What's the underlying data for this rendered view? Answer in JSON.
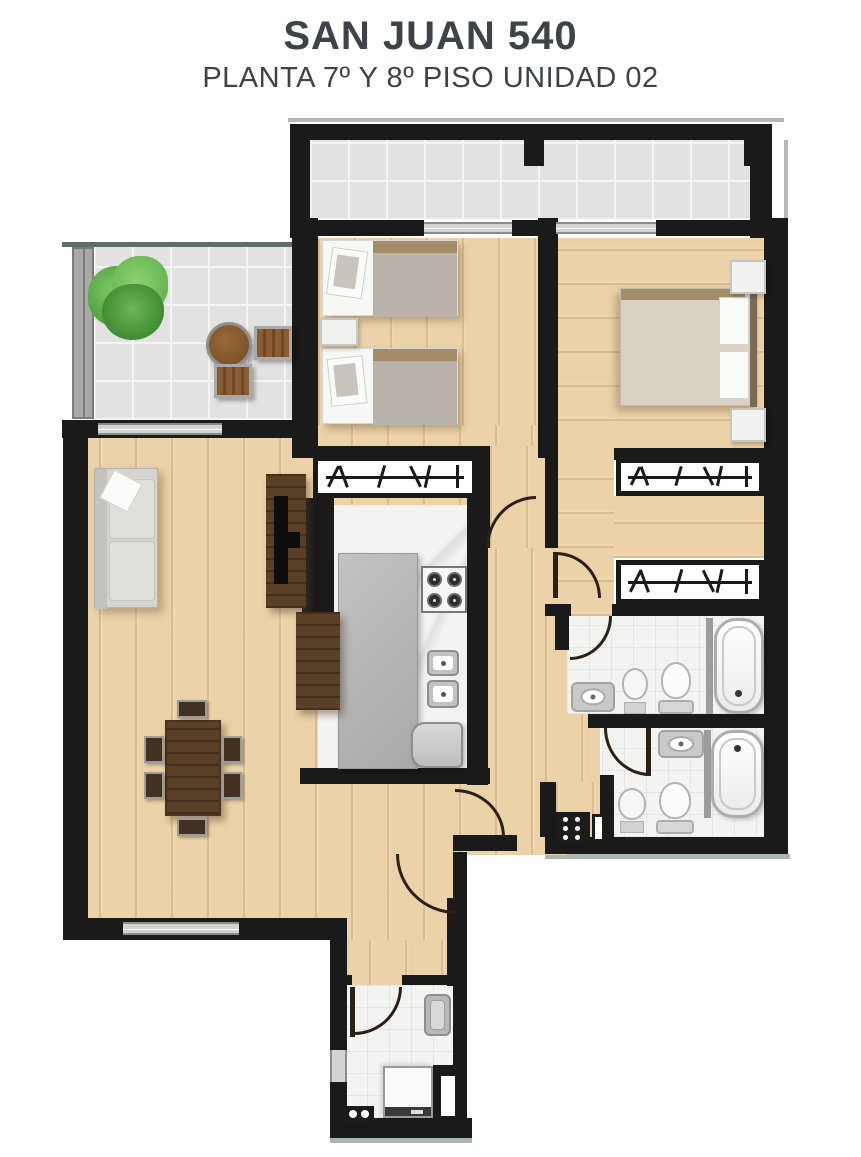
{
  "title": "SAN JUAN 540",
  "subtitle": "PLANTA 7º Y 8º PISO UNIDAD 02",
  "colors": {
    "title_text": "#3d4348",
    "wall": "#1a1a1a",
    "wood": "#ecd2a8",
    "tile": "#e2e2e0",
    "tile_line": "#f4f4f2",
    "bath_tile": "#f3f3f1",
    "marble": "#f4f3f1",
    "island": "#b4b4b2",
    "dark_wood": "#5a4026",
    "sofa": "#d5d4d0",
    "bed_gray": "#b9b3ab",
    "bed_beige": "#d8d1c4",
    "duvet_trim": "#a58c68",
    "plant_green": "#58a844",
    "slab_teal": "#5b6f68",
    "slab_gray": "#a9b5b1"
  },
  "fixtures": {
    "balcony": [
      "plant",
      "patio-table",
      "patio-chair",
      "patio-chair"
    ],
    "bedroom_2": [
      "single-bed",
      "single-bed",
      "nightstand",
      "wardrobe"
    ],
    "master_bedroom": [
      "double-bed",
      "nightstand",
      "nightstand",
      "wardrobe",
      "wardrobe"
    ],
    "living_dining": [
      "sofa",
      "tv-console",
      "dining-table",
      "chairs-x6"
    ],
    "kitchen": [
      "island",
      "stove",
      "double-sink",
      "refrigerator",
      "desk"
    ],
    "bathroom_1": [
      "vanity-sink",
      "bidet",
      "toilet",
      "bathtub"
    ],
    "bathroom_2": [
      "vanity-sink",
      "bidet",
      "toilet",
      "bathtub"
    ],
    "laundry": [
      "laundry-sink",
      "washing-machine",
      "taps",
      "electrical-panel"
    ]
  }
}
